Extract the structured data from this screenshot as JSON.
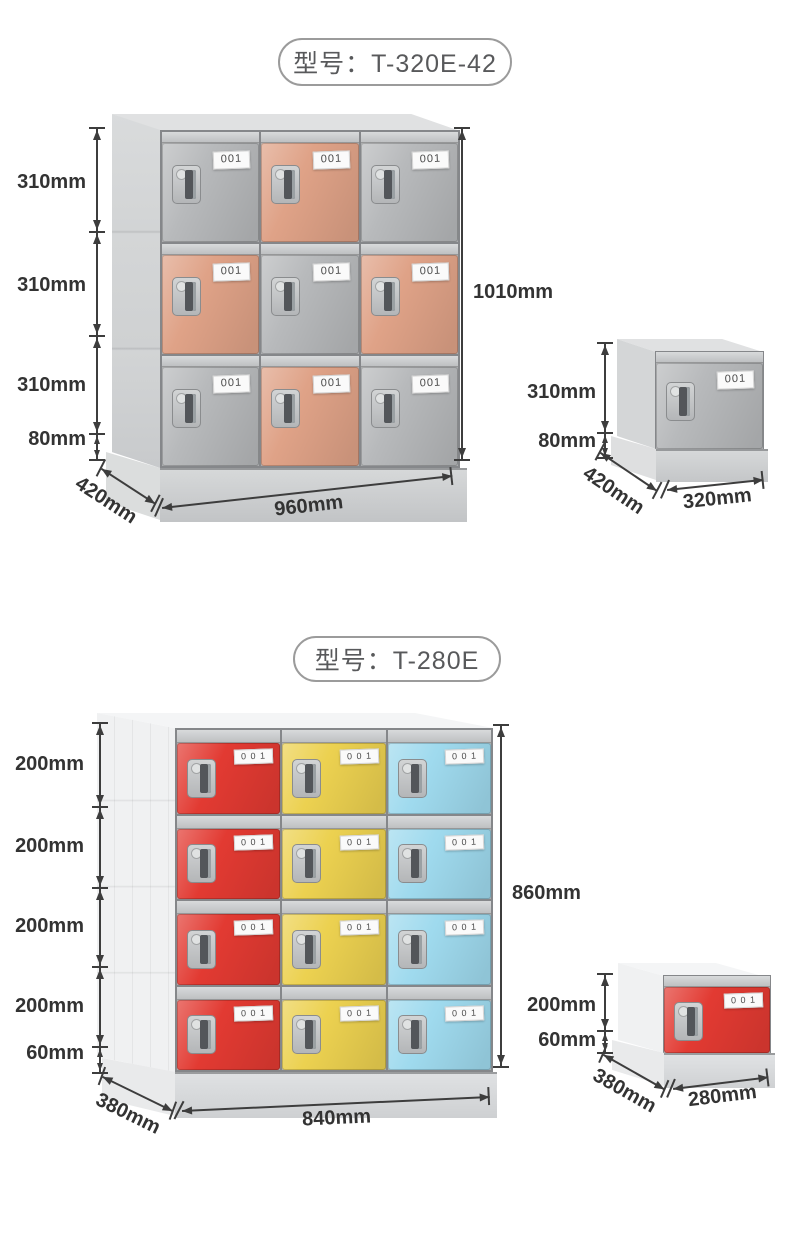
{
  "colors": {
    "gray_door": "#b7b9bb",
    "orange_door": "#dfa287",
    "red_door": "#e23a32",
    "yellow_door": "#ecd150",
    "blue_door": "#9fdaee",
    "cab_side_1": "#d4d6d7",
    "cab_top_1": "#e0e1e2",
    "cab_base_1": "#cbcdcf",
    "cab_side_2": "#f0f1f2",
    "cab_top_2": "#f4f5f6",
    "cab_base_2": "#d7d9db",
    "dim": "#3d3d3d",
    "text": "#333333",
    "title_text": "#58595b",
    "title_border": "#9b9b9b",
    "plate_bg": "#fafafa",
    "plate_text": "#4a4a4a"
  },
  "section1": {
    "title": "型号：T-320E-42",
    "plate_label": "001",
    "cabinet": {
      "rows": 3,
      "cols": 3,
      "pattern": [
        [
          "gray",
          "orange",
          "gray"
        ],
        [
          "orange",
          "gray",
          "orange"
        ],
        [
          "gray",
          "orange",
          "gray"
        ]
      ]
    },
    "dims": {
      "row_heights": [
        "310mm",
        "310mm",
        "310mm"
      ],
      "base_height": "80mm",
      "total_height": "1010mm",
      "width": "960mm",
      "depth": "420mm"
    },
    "single": {
      "plate_label": "001",
      "color": "gray",
      "dims": {
        "height": "310mm",
        "base": "80mm",
        "depth": "420mm",
        "width": "320mm"
      }
    }
  },
  "section2": {
    "title": "型号：T-280E",
    "plate_label": "0 0 1",
    "cabinet": {
      "rows": 4,
      "cols": 3,
      "pattern": [
        [
          "red",
          "yellow",
          "blue"
        ],
        [
          "red",
          "yellow",
          "blue"
        ],
        [
          "red",
          "yellow",
          "blue"
        ],
        [
          "red",
          "yellow",
          "blue"
        ]
      ]
    },
    "dims": {
      "row_heights": [
        "200mm",
        "200mm",
        "200mm",
        "200mm"
      ],
      "base_height": "60mm",
      "total_height": "860mm",
      "width": "840mm",
      "depth": "380mm"
    },
    "single": {
      "plate_label": "0 0 1",
      "color": "red",
      "dims": {
        "height": "200mm",
        "base": "60mm",
        "depth": "380mm",
        "width": "280mm"
      }
    }
  }
}
